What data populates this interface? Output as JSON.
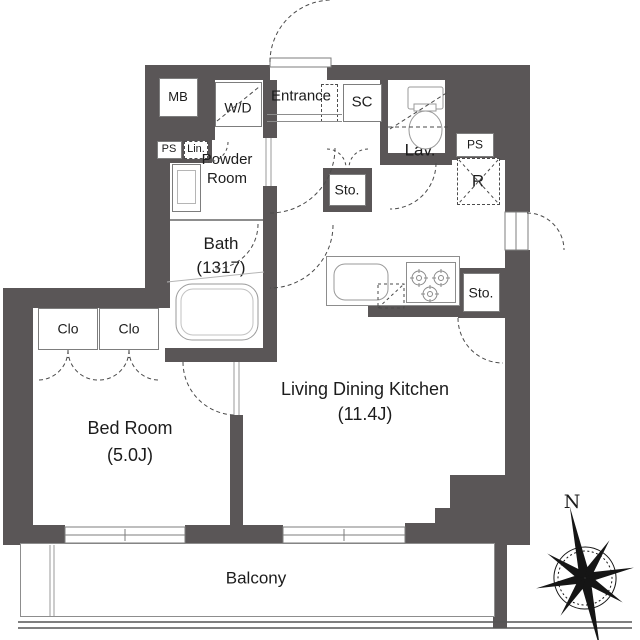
{
  "colors": {
    "wall": "#5a5657",
    "text": "#1c1c1c"
  },
  "rooms": {
    "mb": "MB",
    "washer_dryer": "W/D",
    "entrance": "Entrance",
    "shoe_closet": "SC",
    "lavatory": "Lav.",
    "pipe_space_right": "PS",
    "refrigerator": "R",
    "pipe_space_left": "PS",
    "linen": "Lin.",
    "powder_room": "Powder\nRoom",
    "storage_hall": "Sto.",
    "bath": "Bath\n(1317)",
    "storage_kitchen": "Sto.",
    "closet_left": "Clo",
    "closet_right": "Clo",
    "bedroom": "Bed Room\n(5.0J)",
    "living_dining_kitchen": "Living Dining Kitchen\n(11.4J)",
    "balcony": "Balcony"
  },
  "compass": {
    "north": "N"
  }
}
